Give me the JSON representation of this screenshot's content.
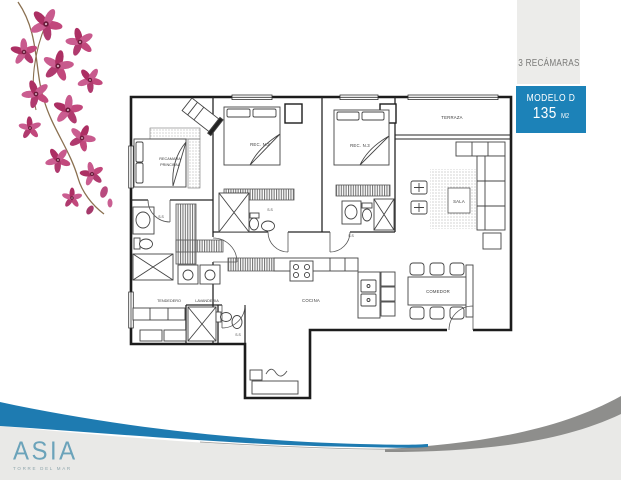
{
  "side_panel": {
    "bedrooms_label": "3 RECÁMARAS",
    "model_label": "MODELO D",
    "area_value": "135",
    "area_unit": "M2"
  },
  "footer": {
    "logo_text": "ASIA",
    "tagline": "TORRE DEL MAR"
  },
  "floor_plan": {
    "rooms": {
      "master_line1": "RECAMARA",
      "master_line2": "PRINCIPAL",
      "bedroom2": "REC. N.2",
      "bedroom3": "REC. N.3",
      "terrace": "TERRAZA",
      "living": "SALA",
      "dining": "COMEDOR",
      "kitchen": "COCINA",
      "drying": "TENDEDERO",
      "laundry": "LAVANDERIA",
      "bath": "S.S"
    }
  },
  "colors": {
    "accent_blue": "#1c82b8",
    "swoosh_blue": "#1e7bb1",
    "swoosh_gray": "#8e8e8c",
    "footer_gray": "#e9e9e7",
    "panel_gray": "#ececea",
    "logo_blue": "#6ba3ba",
    "flower_pink": "#c2487c",
    "plan_line": "#2a2a2a"
  }
}
